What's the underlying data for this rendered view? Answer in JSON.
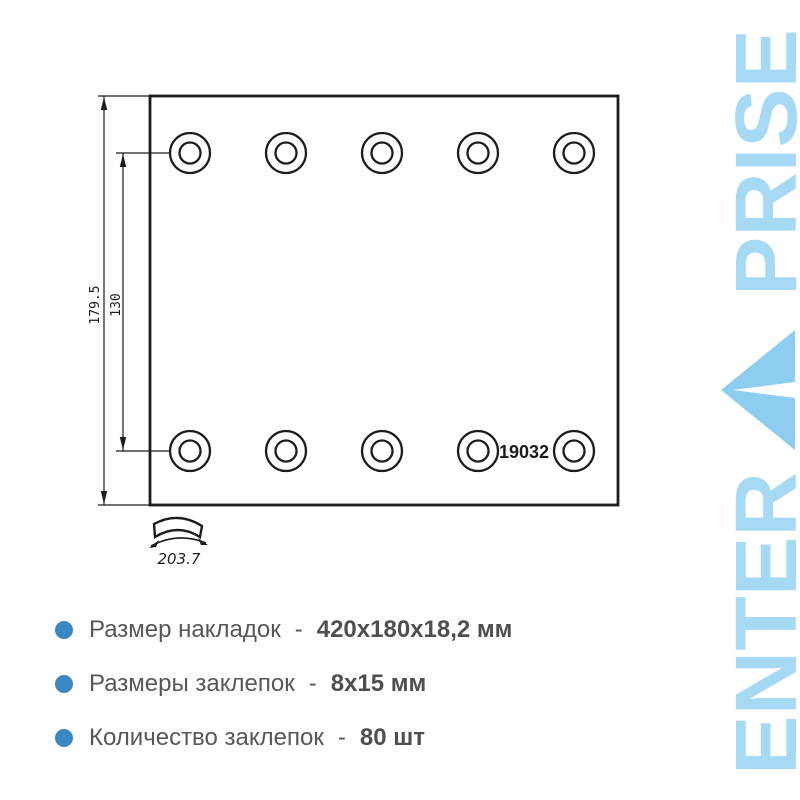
{
  "logo": {
    "top_word": "PRISE",
    "bottom_word": "ENTER",
    "letter_color": "#a6d9f4",
    "triangle_color": "#8ccdf0"
  },
  "drawing": {
    "part_number": "19032",
    "dims": {
      "overall_height": "179.5",
      "hole_spacing": "130",
      "arc_width": "203.7"
    }
  },
  "specs": {
    "bullet_color": "#3b87c4",
    "items": [
      {
        "label": "Размер накладок",
        "dash": "-",
        "value": "420х180х18,2 мм"
      },
      {
        "label": "Размеры заклепок",
        "dash": "-",
        "value": "8х15 мм"
      },
      {
        "label": "Количество заклепок",
        "dash": "-",
        "value": "80 шт"
      }
    ]
  }
}
